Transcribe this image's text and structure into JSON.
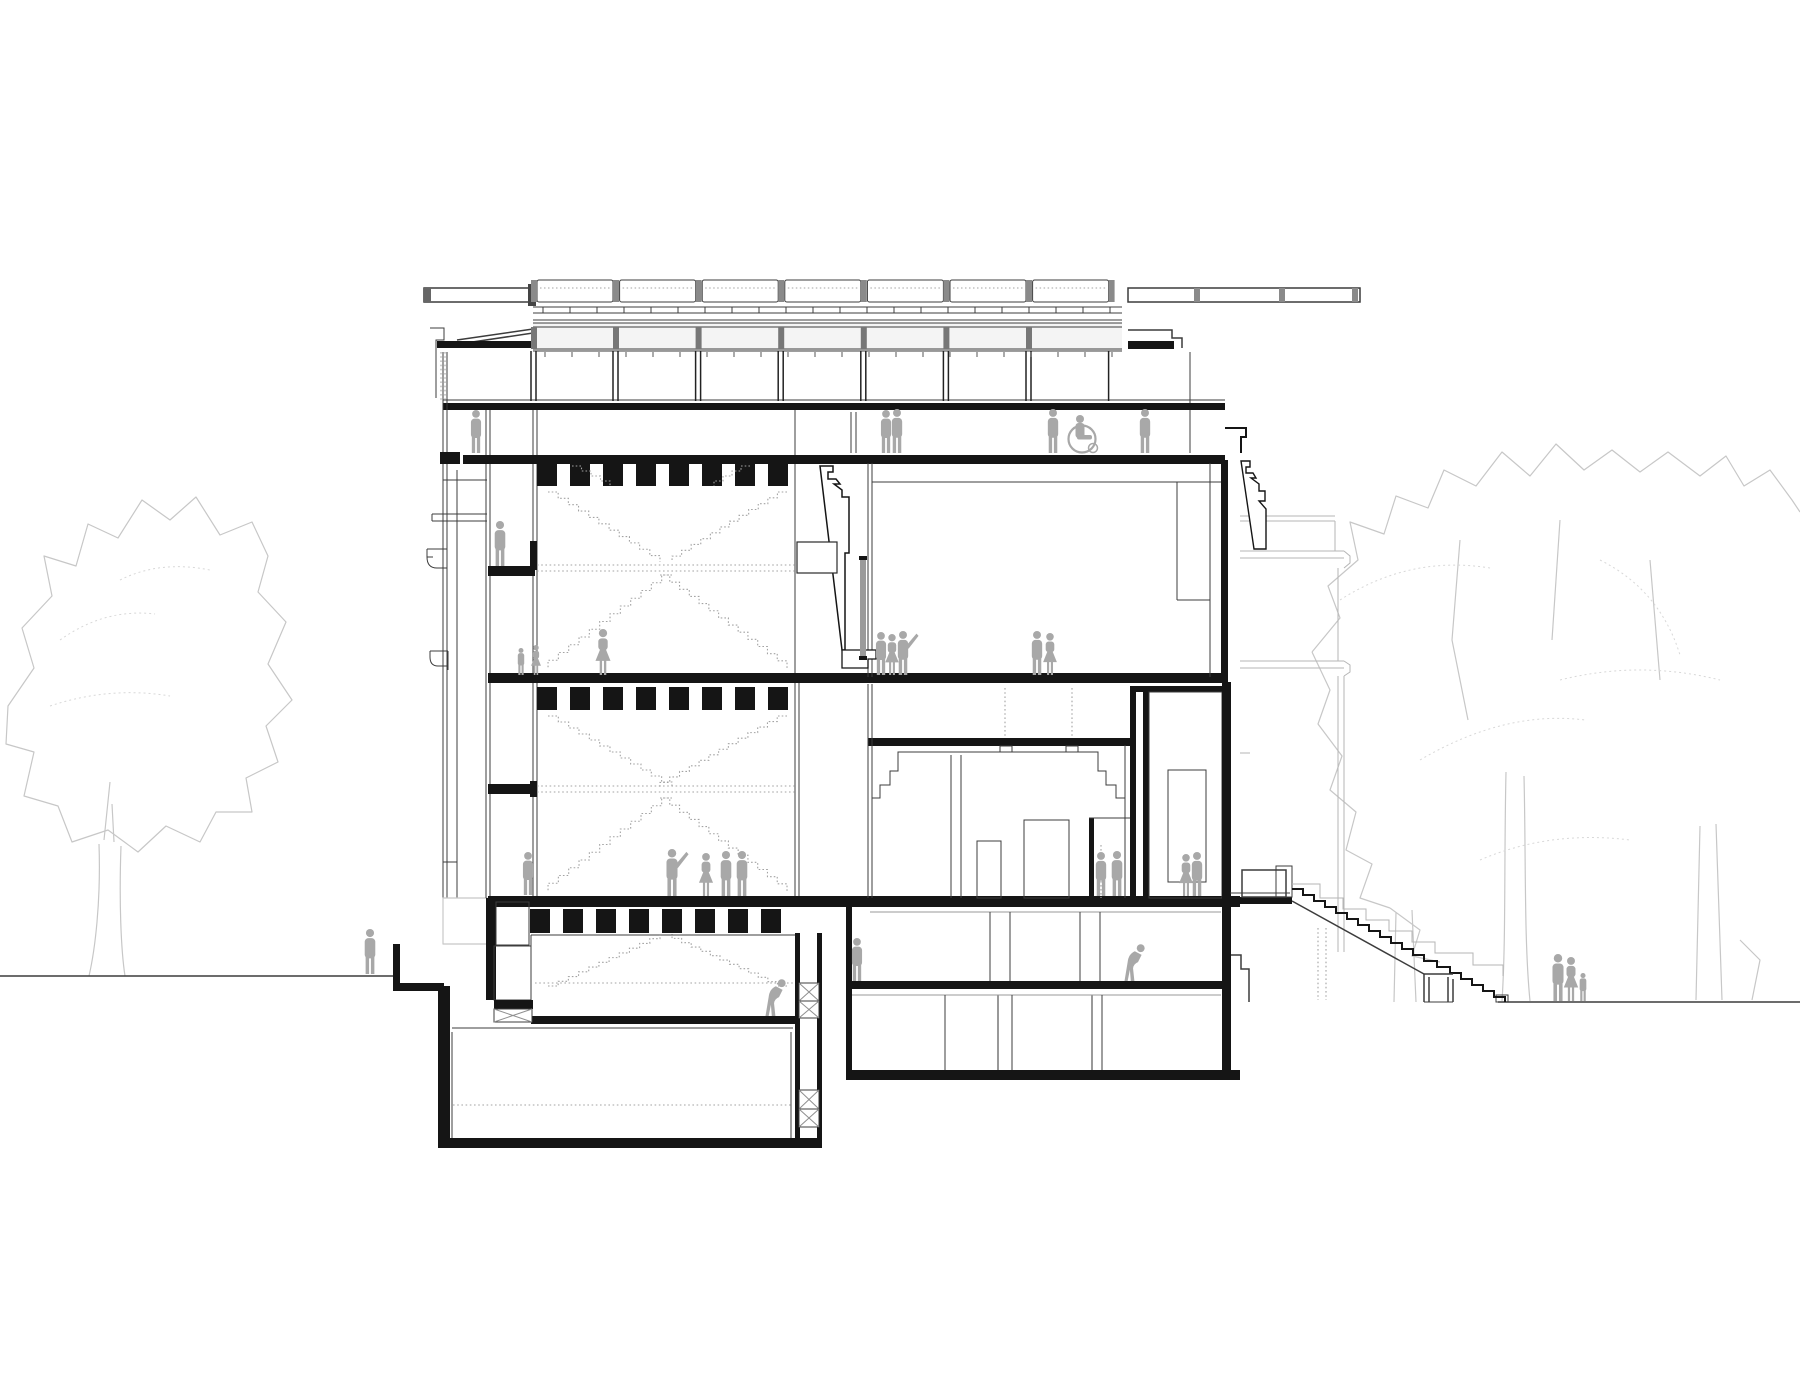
{
  "meta": {
    "kind": "architectural-section-drawing",
    "description": "Black-and-white building cross-section with roof monitors, stair hall with crossing stairs, galleries, basement, exterior steps, scale figures and trees"
  },
  "palette": {
    "paper": "#ffffff",
    "cut": "#151515",
    "line": "#3c3c3c",
    "light": "#8f8f8f",
    "faint": "#c7c7c7",
    "dotted": "#a3a3a3",
    "figure": "#a8a8a8",
    "posts": "#8a8a8a"
  },
  "roof_monitors": {
    "x0": 537,
    "y": 280,
    "w": 76,
    "gap": 6.6,
    "h": 22,
    "count": 7,
    "mullion_y1": 351,
    "mullion_y2": 401,
    "band_y": 327,
    "band_h": 22
  },
  "louver_ticks": {
    "x1": 543,
    "x2": 1118,
    "step": 27,
    "y1": 307,
    "y2": 313
  },
  "window_ticks": {
    "x1": 545,
    "x2": 1118,
    "step": 27,
    "y1": 352,
    "y2": 357
  },
  "joist_bands": [
    {
      "x1": 537,
      "x2": 795,
      "y": 463,
      "h": 23
    },
    {
      "x1": 537,
      "x2": 795,
      "y": 687,
      "h": 23
    },
    {
      "x1": 530,
      "x2": 795,
      "y": 909,
      "h": 24
    }
  ],
  "stair_flights": [
    [
      548,
      492,
      660,
      562
    ],
    [
      787,
      492,
      672,
      562
    ],
    [
      660,
      575,
      787,
      668
    ],
    [
      672,
      575,
      548,
      668
    ],
    [
      572,
      466,
      610,
      486
    ],
    [
      750,
      466,
      714,
      486
    ],
    [
      548,
      716,
      672,
      788
    ],
    [
      787,
      716,
      660,
      788
    ],
    [
      660,
      798,
      787,
      891
    ],
    [
      672,
      798,
      548,
      891
    ],
    [
      548,
      986,
      660,
      934
    ],
    [
      787,
      986,
      672,
      934
    ]
  ],
  "dotted_lines": [
    [
      537,
      565,
      837,
      565
    ],
    [
      537,
      571,
      837,
      571
    ],
    [
      537,
      786,
      795,
      786
    ],
    [
      537,
      792,
      795,
      792
    ],
    [
      535,
      983,
      793,
      983
    ],
    [
      453,
      1105,
      791,
      1105
    ],
    [
      1005,
      688,
      1005,
      738
    ],
    [
      1072,
      688,
      1072,
      738
    ],
    [
      1318,
      928,
      1318,
      1000
    ],
    [
      1326,
      928,
      1326,
      1000
    ],
    [
      441,
      352,
      441,
      400
    ],
    [
      445,
      352,
      445,
      400
    ]
  ],
  "hatch_boxes": [
    [
      799,
      983,
      20,
      18
    ],
    [
      799,
      1001,
      20,
      17
    ],
    [
      799,
      1090,
      20,
      19
    ],
    [
      799,
      1109,
      20,
      18
    ],
    [
      494,
      1009,
      38,
      13
    ]
  ],
  "people": [
    {
      "x": 476,
      "y": 453,
      "h": 44,
      "t": "stand"
    },
    {
      "x": 886,
      "y": 453,
      "h": 44,
      "t": "stand"
    },
    {
      "x": 897,
      "y": 453,
      "h": 45,
      "t": "stand"
    },
    {
      "x": 1053,
      "y": 453,
      "h": 45,
      "t": "stand"
    },
    {
      "x": 1082,
      "y": 453,
      "h": 40,
      "t": "wheelchair"
    },
    {
      "x": 1145,
      "y": 453,
      "h": 45,
      "t": "stand"
    },
    {
      "x": 500,
      "y": 566,
      "h": 46,
      "t": "stand"
    },
    {
      "x": 521,
      "y": 675,
      "h": 28,
      "t": "stand"
    },
    {
      "x": 536,
      "y": 675,
      "h": 31,
      "t": "woman"
    },
    {
      "x": 603,
      "y": 675,
      "h": 47,
      "t": "woman"
    },
    {
      "x": 881,
      "y": 675,
      "h": 44,
      "t": "stand"
    },
    {
      "x": 892,
      "y": 675,
      "h": 42,
      "t": "woman"
    },
    {
      "x": 903,
      "y": 675,
      "h": 45,
      "t": "arm"
    },
    {
      "x": 1037,
      "y": 675,
      "h": 45,
      "t": "stand"
    },
    {
      "x": 1050,
      "y": 675,
      "h": 43,
      "t": "woman"
    },
    {
      "x": 528,
      "y": 895,
      "h": 44,
      "t": "stand"
    },
    {
      "x": 672,
      "y": 896,
      "h": 48,
      "t": "arm"
    },
    {
      "x": 706,
      "y": 896,
      "h": 44,
      "t": "woman"
    },
    {
      "x": 726,
      "y": 896,
      "h": 46,
      "t": "stand"
    },
    {
      "x": 742,
      "y": 896,
      "h": 46,
      "t": "stand"
    },
    {
      "x": 1101,
      "y": 896,
      "h": 45,
      "t": "stand"
    },
    {
      "x": 1117,
      "y": 896,
      "h": 46,
      "t": "stand",
      "f": true
    },
    {
      "x": 1186,
      "y": 896,
      "h": 43,
      "t": "woman"
    },
    {
      "x": 1197,
      "y": 896,
      "h": 45,
      "t": "stand"
    },
    {
      "x": 770,
      "y": 1016,
      "h": 45,
      "t": "bend"
    },
    {
      "x": 857,
      "y": 981,
      "h": 44,
      "t": "stand"
    },
    {
      "x": 1129,
      "y": 981,
      "h": 45,
      "t": "bend"
    },
    {
      "x": 370,
      "y": 974,
      "h": 46,
      "t": "stand"
    },
    {
      "x": 1558,
      "y": 1001,
      "h": 48,
      "t": "stand"
    },
    {
      "x": 1571,
      "y": 1001,
      "h": 45,
      "t": "woman"
    },
    {
      "x": 1583,
      "y": 1001,
      "h": 29,
      "t": "child"
    }
  ]
}
